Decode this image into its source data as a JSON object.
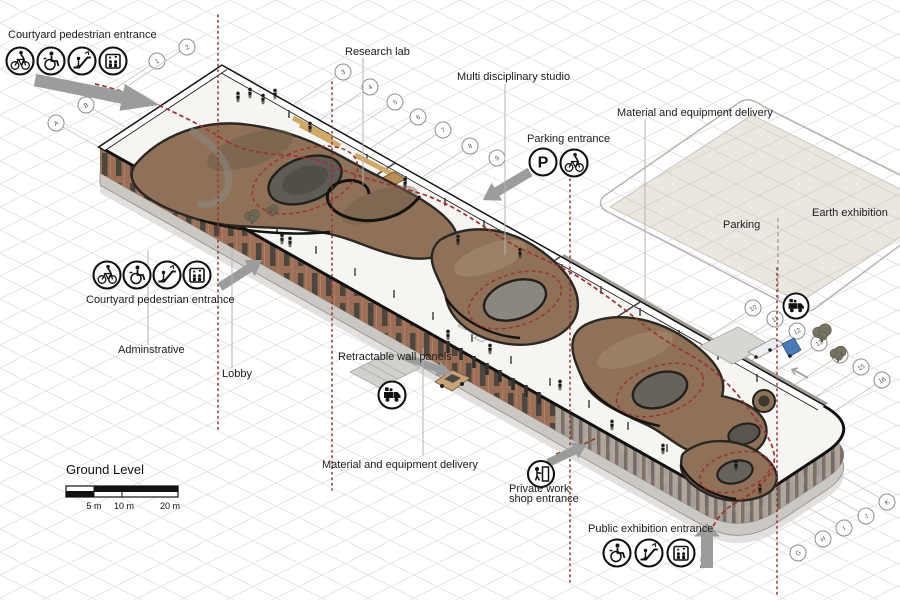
{
  "title": "Ground Level",
  "labels": {
    "courtyard_top": "Courtyard pedestrian entrance",
    "research_lab": "Research lab",
    "multi_studio": "Multi disciplinary studio",
    "parking_entrance": "Parking entrance",
    "material_delivery_top": "Material and equipment delivery",
    "parking_area": "Parking",
    "earth_exhibition": "Earth exhibition",
    "courtyard_left": "Courtyard pedestrian entrance",
    "administrative": "Adminstrative",
    "lobby": "Lobby",
    "retractable_panels": "Retractable wall panels",
    "material_delivery_bottom": "Material and equipment delivery",
    "private_workshop_1": "Private work-",
    "private_workshop_2": "shop entrance",
    "public_exhibition": "Public exhibition entrance"
  },
  "scale_bar": {
    "title": "Ground Level",
    "ticks": [
      "5 m",
      "10 m",
      "20 m"
    ]
  },
  "grid_bubbles": {
    "numbers": [
      "1",
      "2",
      "3",
      "4",
      "5",
      "6",
      "7",
      "8",
      "9",
      "10",
      "11",
      "12",
      "13",
      "14",
      "15",
      "16"
    ],
    "letters_top_left": [
      "A",
      "B"
    ],
    "letters_bottom_right": [
      "G",
      "H",
      "I",
      "J",
      "K"
    ]
  },
  "icons": {
    "parking_glyph": "P",
    "courtyard_entrance": [
      "bicycle-icon",
      "wheelchair-icon",
      "escalator-icon",
      "elevator-icon"
    ],
    "parking_entrance": [
      "parking-icon",
      "bicycle-icon"
    ],
    "public_exhibition": [
      "wheelchair-icon",
      "escalator-icon",
      "elevator-icon"
    ],
    "private_workshop": [
      "door-person-icon"
    ],
    "material_delivery": [
      "delivery-truck-icon"
    ]
  },
  "colors": {
    "circulation_red": "#9b3333",
    "brick_facade": "#9b6e57",
    "terrain_brown": "#8f7159",
    "parking_fill": "#eae7e1",
    "arrow_gray": "#9c9c9c",
    "grid_line": "#e4e4e4",
    "truck_blue": "#4a7ab5",
    "car_tan": "#c8a377"
  }
}
